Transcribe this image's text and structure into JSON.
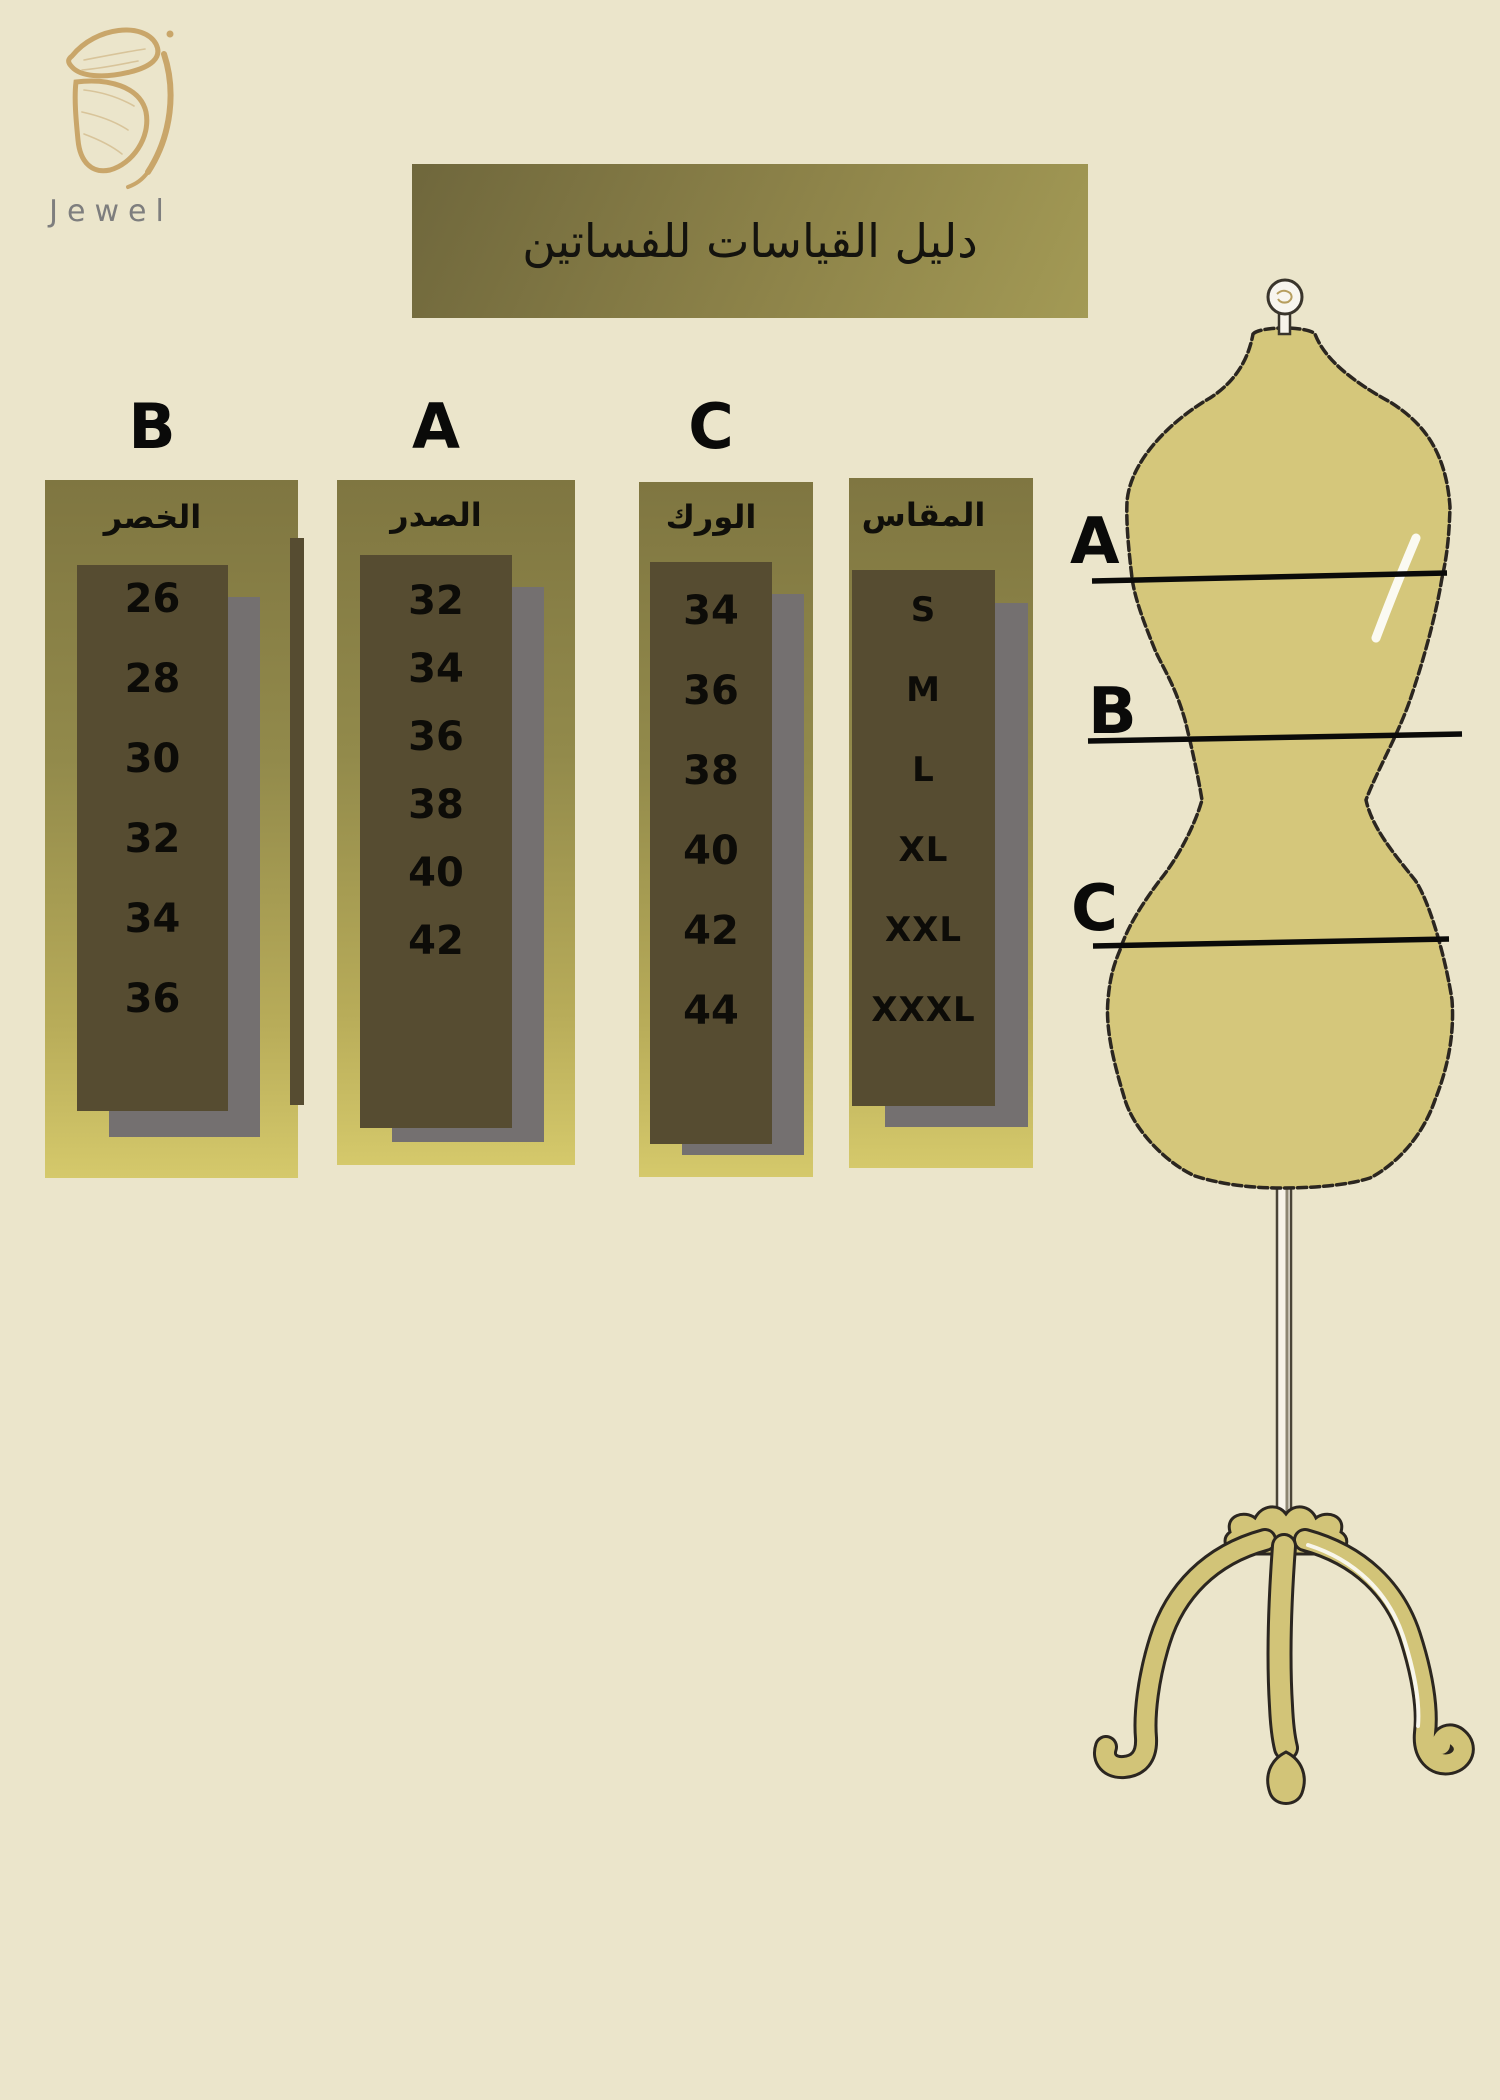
{
  "brand": {
    "name": "Jewel",
    "logo_icon": "butterfly-wing-icon"
  },
  "title": "دليل القياسات للفساتين",
  "size_guide": {
    "columns": [
      {
        "letter": "B",
        "header": "الخصر",
        "values": [
          "26",
          "28",
          "30",
          "32",
          "34",
          "36"
        ]
      },
      {
        "letter": "A",
        "header": "الصدر",
        "values": [
          "32",
          "34",
          "36",
          "38",
          "40",
          "42"
        ]
      },
      {
        "letter": "C",
        "header": "الورك",
        "values": [
          "34",
          "36",
          "38",
          "40",
          "42",
          "44"
        ]
      },
      {
        "letter": "",
        "header": "المقاس",
        "values": [
          "S",
          "M",
          "L",
          "XL",
          "XXL",
          "XXXL"
        ]
      }
    ]
  },
  "mannequin": {
    "labels": [
      "A",
      "B",
      "C"
    ]
  },
  "chart_data": {
    "type": "table",
    "title": "دليل القياسات للفساتين",
    "columns": [
      "المقاس",
      "الصدر (A)",
      "الخصر (B)",
      "الورك (C)"
    ],
    "rows": [
      [
        "S",
        "32",
        "26",
        "34"
      ],
      [
        "M",
        "34",
        "28",
        "36"
      ],
      [
        "L",
        "36",
        "30",
        "38"
      ],
      [
        "XL",
        "38",
        "32",
        "40"
      ],
      [
        "XXL",
        "40",
        "34",
        "42"
      ],
      [
        "XXXL",
        "42",
        "36",
        "44"
      ]
    ]
  },
  "colors": {
    "background": "#ebe5cb",
    "panel_olive_top": "#7f7641",
    "panel_olive_bottom": "#d5c96b",
    "dark_box": "#564c31",
    "shadow_gray": "#747070",
    "mannequin_fill": "#d5c77b",
    "logo_gold": "#c9a66a",
    "text_black": "#0d0c08",
    "brand_gray": "#7e7e7e"
  }
}
